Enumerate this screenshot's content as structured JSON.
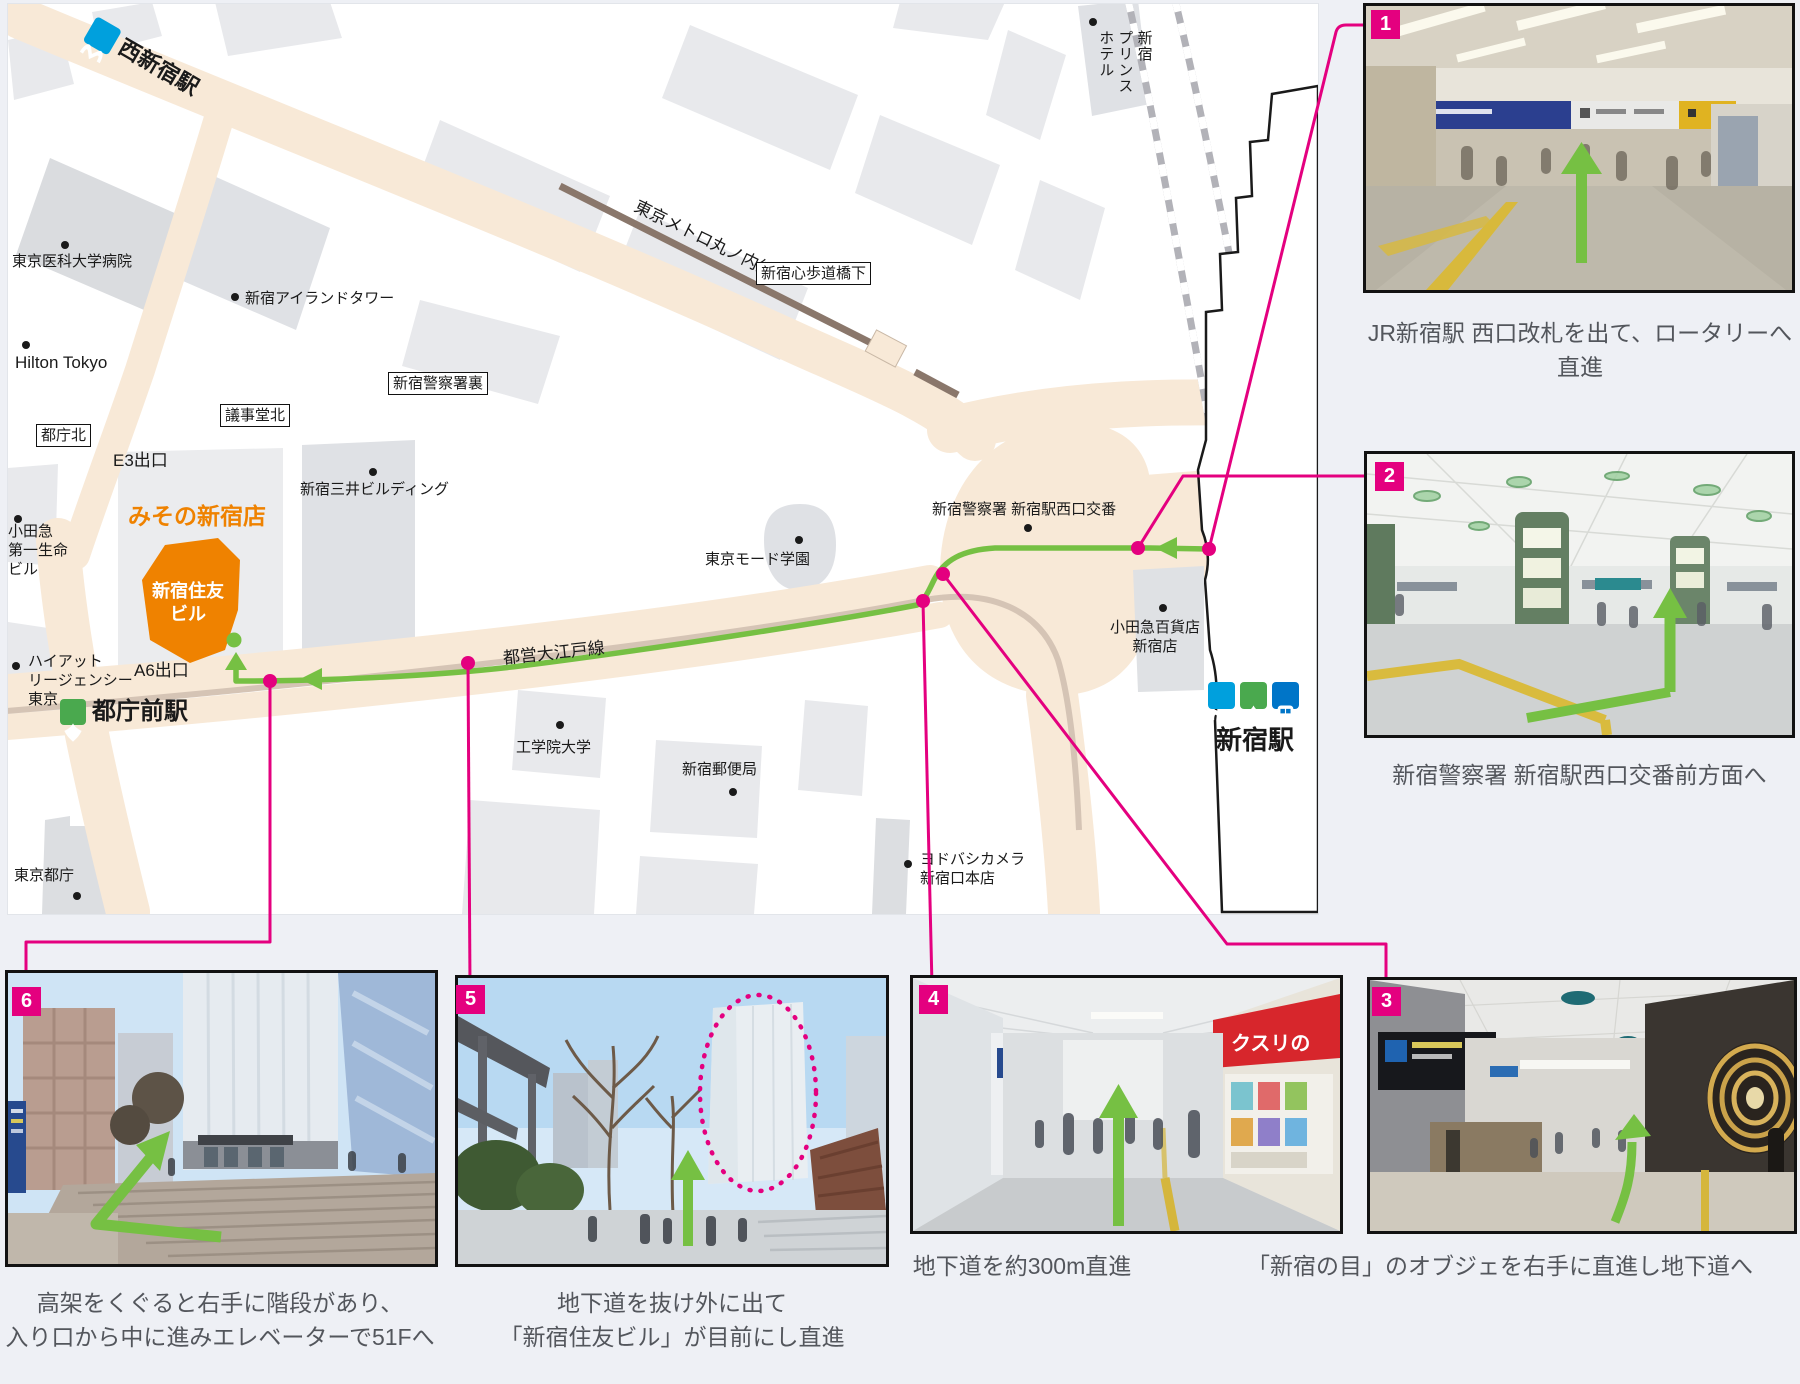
{
  "colors": {
    "route_green": "#76c043",
    "connector_pink": "#e4007f",
    "road_cream": "#f8e9d7",
    "marunouchi_brown": "#8a776b",
    "orange_building": "#ef8200"
  },
  "map": {
    "stations": {
      "nishi_shinjuku": "西新宿駅",
      "tochomae": "都庁前駅",
      "shinjuku": "新宿駅"
    },
    "lines": {
      "marunouchi": "東京メトロ丸ノ内線",
      "oedo": "都営大江戸線"
    },
    "intersections": {
      "tocho_kita": "都庁北",
      "gijido_kita": "議事堂北",
      "keisatsusho_ura": "新宿警察署裏",
      "hodokyo_shita": "新宿心歩道橋下"
    },
    "places": {
      "tokyo_med": "東京医科大学病院",
      "island_tower": "新宿アイランドタワー",
      "hilton": "Hilton Tokyo",
      "mitsui": "新宿三井ビルディング",
      "misono": "みその新宿店",
      "sumitomo": "新宿住友\nビル",
      "odakyu_daiichi": "小田急\n第一生命\nビル",
      "hyatt": "ハイアット\nリージェンシー\n東京",
      "exit_e3": "E3出口",
      "exit_a6": "A6出口",
      "tocho": "東京都庁",
      "kogakuin": "工学院大学",
      "mode_gakuen": "東京モード学園",
      "post_office": "新宿郵便局",
      "yodobashi": "ヨドバシカメラ\n新宿口本店",
      "police_box": "新宿警察署 新宿駅西口交番",
      "odakyu_dept": "小田急百貨店\n新宿店",
      "prince": "新宿\nプリンス\nホテル"
    }
  },
  "steps": [
    {
      "number": "1",
      "line1": "JR新宿駅 西口改札を出て、ロータリーへ直進",
      "line2": ""
    },
    {
      "number": "2",
      "line1": "新宿警察署 新宿駅西口交番前方面へ",
      "line2": ""
    },
    {
      "number": "3",
      "line1": "「新宿の目」のオブジェを右手に直進し地下道へ",
      "line2": ""
    },
    {
      "number": "4",
      "line1": "地下道を約300m直進",
      "line2": ""
    },
    {
      "number": "5",
      "line1": "地下道を抜け外に出て",
      "line2": "「新宿住友ビル」が目前にし直進"
    },
    {
      "number": "6",
      "line1": "高架をくぐると右手に階段があり、",
      "line2": "入り口から中に進みエレベーターで51Fへ"
    }
  ],
  "photo_signs": {
    "drugstore": "クスリの"
  }
}
